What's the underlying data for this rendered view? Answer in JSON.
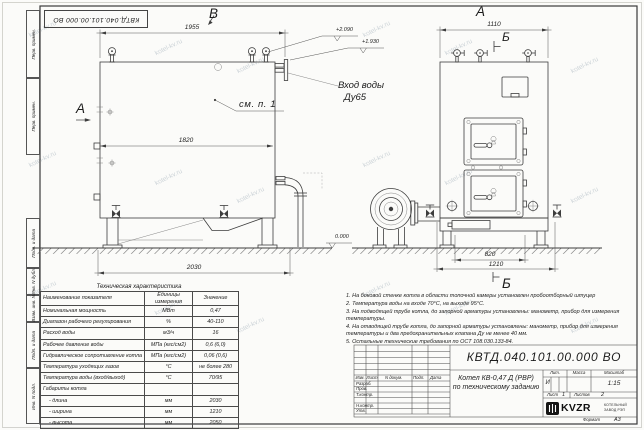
{
  "corner_stamp": {
    "doc_number": "КВТД.040.101.00.000  ВО"
  },
  "margin": {
    "boxes": [
      "Перв. примен.",
      "Перв. примен.",
      "Подп. и дата",
      "Инв. N дубл.",
      "Взам. инв. N",
      "Подп. и дата",
      "Инв. N подл."
    ]
  },
  "drawing": {
    "labels": {
      "view_b": "В",
      "section_a": "А",
      "view_a": "А",
      "section_b_top": "Б",
      "section_b_bottom": "Б",
      "see_note": "см. п. 1"
    },
    "inlet": {
      "line1": "Вход воды",
      "line2": "Ду65"
    },
    "dims": {
      "front_top": "1955",
      "front_inner": "1820",
      "front_bottom": "2030",
      "side_top": "1110",
      "side_820": "820",
      "side_1210": "1210"
    },
    "elevations": {
      "high": "+2.090",
      "low": "+1.930",
      "zero": "0.000"
    }
  },
  "spec_table": {
    "title": "Техническая характеристика",
    "headers": [
      "Наименование показателя",
      "Единицы измерения",
      "Значение"
    ],
    "rows": [
      [
        "Номинальная мощность",
        "МВт",
        "0,47"
      ],
      [
        "Диапазон рабочего регулирования",
        "%",
        "40-110"
      ],
      [
        "Расход воды",
        "м3/ч",
        "16"
      ],
      [
        "Рабочее давление воды",
        "МПа (кгс/см2)",
        "0,6 (6,0)"
      ],
      [
        "Гидравлическое сопротивление котла",
        "МПа (кгс/см2)",
        "0,06 (0,6)"
      ],
      [
        "Температура уходящих газов",
        "°С",
        "не более 280"
      ],
      [
        "Температура воды (вход/выход)",
        "°С",
        "70/95"
      ],
      [
        "Габариты котла",
        "",
        ""
      ],
      [
        "    - длина",
        "мм",
        "2030"
      ],
      [
        "    - ширина",
        "мм",
        "1210"
      ],
      [
        "    - высота",
        "мм",
        "2050"
      ]
    ]
  },
  "notes": {
    "items": [
      "1. На боковой стенке котла в области топочной камеры установлен пробоотборный штуцер",
      "2. Температура воды на входе 70°С, на выходе 95°С.",
      "3. На подводящей трубе котла, до запорной арматуры установлены: манометр, прибор для измерения температуры.",
      "4. На отводящей трубе котла, до запорной арматуры установлены: манометр, прибор для измерения температуры и два предохранительных клапана Ду не менее 40 мм.",
      "5. Остальные технические требования по ОСТ 108.030.133-84."
    ]
  },
  "title_block": {
    "doc_number": "КВТД.040.101.00.000  ВО",
    "product_line1": "Котел  КВ-0,47 Д  (РВР)",
    "product_line2": "по техническому заданию",
    "change_header": [
      "Изм.",
      "Лист",
      "N докум.",
      "Подп.",
      "Дата"
    ],
    "roles": [
      "Разраб.",
      "Пров.",
      "Т.контр.",
      "Н.контр.",
      "Утв."
    ],
    "lit_label": "Лит.",
    "lit_value": "И",
    "mass_label": "Масса",
    "scale_label": "Масштаб",
    "scale_value": "1:15",
    "sheet_label": "Лист",
    "sheet_value": "1",
    "sheets_label": "Листов",
    "sheets_value": "2",
    "brand": "KVZR",
    "brand_line1": "КОТЕЛЬНЫЙ",
    "brand_line2": "ЗАВОД РЭП",
    "format_label": "Формат",
    "format_value": "А3"
  },
  "watermark": {
    "text": "kotel-kv.ru"
  }
}
